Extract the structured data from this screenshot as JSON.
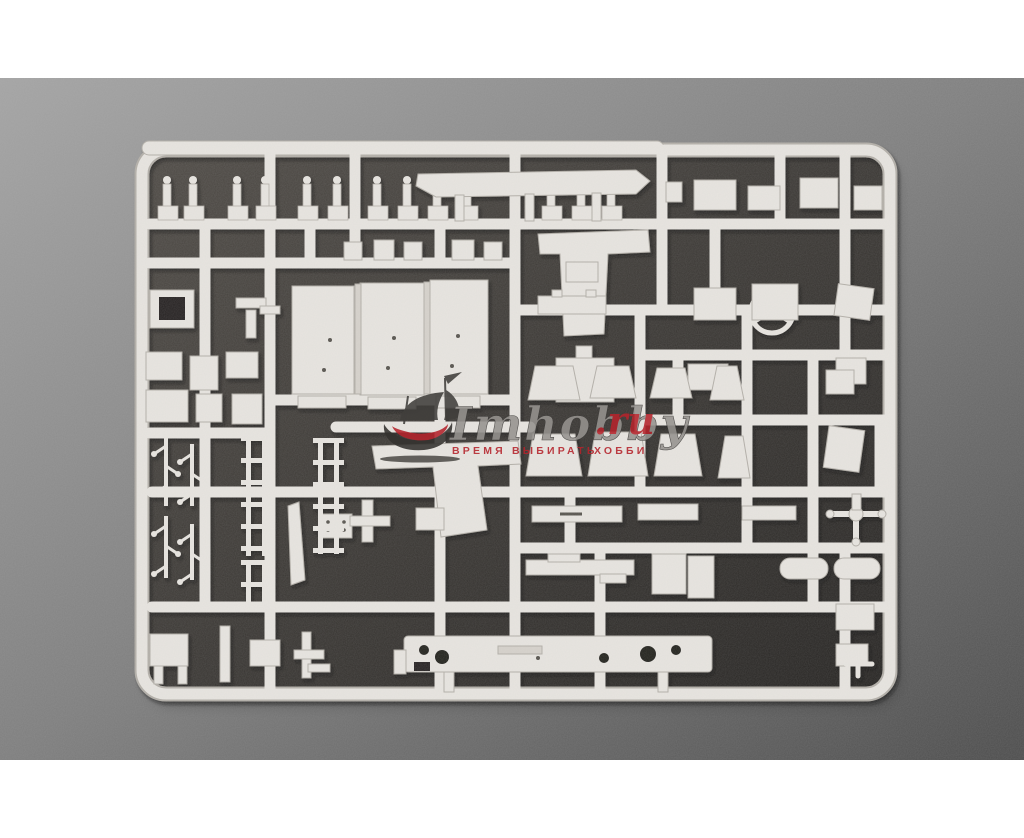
{
  "photo": {
    "palette": {
      "pageBg": "#ffffff",
      "bgTop": "#a4a4a4",
      "bgMid": "#7e7e7e",
      "bgBot": "#4c4c4c",
      "mat1": "#4e4a45",
      "mat2": "#262422",
      "plastic": "#e8e5e0",
      "edge": "#b3afa8",
      "dim": "#d6d2cb",
      "hole": "#23211f",
      "detail": "#57534d",
      "shadow": "#0a0a09"
    },
    "frame": {
      "x": 142,
      "y": 150,
      "w": 748,
      "h": 544,
      "rx": 24
    },
    "topbar": {
      "x": 142,
      "y": 141,
      "w": 522,
      "h": 14
    },
    "runners": [
      [
        150,
        224,
        884,
        224
      ],
      [
        150,
        263,
        513,
        263
      ],
      [
        515,
        310,
        884,
        310
      ],
      [
        640,
        355,
        884,
        355
      ],
      [
        272,
        400,
        513,
        400
      ],
      [
        640,
        420,
        884,
        420
      ],
      [
        150,
        433,
        268,
        433
      ],
      [
        152,
        492,
        884,
        492
      ],
      [
        515,
        548,
        884,
        548
      ],
      [
        152,
        607,
        884,
        607
      ],
      [
        336,
        427,
        530,
        427
      ],
      [
        205,
        224,
        205,
        607
      ],
      [
        270,
        150,
        270,
        688
      ],
      [
        310,
        224,
        310,
        263
      ],
      [
        355,
        150,
        355,
        263
      ],
      [
        440,
        224,
        440,
        263
      ],
      [
        440,
        400,
        440,
        688
      ],
      [
        515,
        150,
        515,
        688
      ],
      [
        570,
        492,
        570,
        548
      ],
      [
        600,
        548,
        600,
        688
      ],
      [
        640,
        310,
        640,
        492
      ],
      [
        662,
        150,
        662,
        310
      ],
      [
        678,
        355,
        678,
        420
      ],
      [
        715,
        224,
        715,
        310
      ],
      [
        747,
        310,
        747,
        548
      ],
      [
        780,
        150,
        780,
        224
      ],
      [
        813,
        355,
        813,
        607
      ],
      [
        845,
        150,
        845,
        355
      ],
      [
        845,
        548,
        845,
        688
      ],
      [
        880,
        420,
        880,
        492
      ]
    ],
    "parts": [
      {
        "t": "post",
        "x": 158
      },
      {
        "t": "post",
        "x": 184
      },
      {
        "t": "post",
        "x": 228
      },
      {
        "t": "post",
        "x": 256
      },
      {
        "t": "post",
        "x": 298
      },
      {
        "t": "post",
        "x": 328
      },
      {
        "t": "post",
        "x": 368
      },
      {
        "t": "post",
        "x": 398
      },
      {
        "t": "post",
        "x": 428
      },
      {
        "t": "post",
        "x": 458
      },
      {
        "t": "post",
        "x": 542
      },
      {
        "t": "post",
        "x": 572
      },
      {
        "t": "post",
        "x": 602
      },
      {
        "t": "poly",
        "pts": "418,174 636,170 650,181 636,194 436,197 416,186"
      },
      {
        "t": "rect",
        "x": 455,
        "y": 195,
        "w": 9,
        "h": 26
      },
      {
        "t": "rect",
        "x": 525,
        "y": 194,
        "w": 9,
        "h": 27
      },
      {
        "t": "rect",
        "x": 592,
        "y": 193,
        "w": 9,
        "h": 28
      },
      {
        "t": "rect",
        "x": 666,
        "y": 182,
        "w": 16,
        "h": 20
      },
      {
        "t": "rect",
        "x": 694,
        "y": 180,
        "w": 42,
        "h": 30
      },
      {
        "t": "rect",
        "x": 748,
        "y": 186,
        "w": 32,
        "h": 24
      },
      {
        "t": "rect",
        "x": 800,
        "y": 178,
        "w": 38,
        "h": 30
      },
      {
        "t": "rect",
        "x": 854,
        "y": 186,
        "w": 28,
        "h": 24
      },
      {
        "t": "rect",
        "x": 344,
        "y": 242,
        "w": 18,
        "h": 18
      },
      {
        "t": "rect",
        "x": 374,
        "y": 240,
        "w": 20,
        "h": 20
      },
      {
        "t": "rect",
        "x": 404,
        "y": 242,
        "w": 18,
        "h": 18
      },
      {
        "t": "rect",
        "x": 452,
        "y": 240,
        "w": 22,
        "h": 20
      },
      {
        "t": "rect",
        "x": 484,
        "y": 242,
        "w": 18,
        "h": 18
      },
      {
        "t": "rect",
        "x": 150,
        "y": 290,
        "w": 44,
        "h": 38
      },
      {
        "t": "rect",
        "x": 159,
        "y": 297,
        "w": 26,
        "h": 23,
        "f": "mat"
      },
      {
        "t": "rect",
        "x": 236,
        "y": 298,
        "w": 30,
        "h": 10
      },
      {
        "t": "rect",
        "x": 246,
        "y": 310,
        "w": 10,
        "h": 28
      },
      {
        "t": "rect",
        "x": 260,
        "y": 306,
        "w": 20,
        "h": 8
      },
      {
        "t": "rect",
        "x": 146,
        "y": 352,
        "w": 36,
        "h": 28
      },
      {
        "t": "rect",
        "x": 190,
        "y": 356,
        "w": 28,
        "h": 34
      },
      {
        "t": "rect",
        "x": 226,
        "y": 352,
        "w": 32,
        "h": 26
      },
      {
        "t": "rect",
        "x": 146,
        "y": 390,
        "w": 42,
        "h": 32
      },
      {
        "t": "rect",
        "x": 196,
        "y": 394,
        "w": 26,
        "h": 28
      },
      {
        "t": "rect",
        "x": 232,
        "y": 394,
        "w": 30,
        "h": 30
      },
      {
        "t": "rect",
        "x": 292,
        "y": 286,
        "w": 62,
        "h": 108
      },
      {
        "t": "rect",
        "x": 360,
        "y": 283,
        "w": 64,
        "h": 112
      },
      {
        "t": "rect",
        "x": 430,
        "y": 280,
        "w": 58,
        "h": 114
      },
      {
        "t": "rect",
        "x": 355,
        "y": 284,
        "w": 6,
        "h": 110,
        "f": "dim"
      },
      {
        "t": "rect",
        "x": 424,
        "y": 282,
        "w": 6,
        "h": 112,
        "f": "dim"
      },
      {
        "t": "rect",
        "x": 298,
        "y": 396,
        "w": 48,
        "h": 12
      },
      {
        "t": "rect",
        "x": 368,
        "y": 397,
        "w": 48,
        "h": 12
      },
      {
        "t": "rect",
        "x": 436,
        "y": 396,
        "w": 44,
        "h": 12
      },
      {
        "t": "dot",
        "cx": 324,
        "cy": 370,
        "r": 2
      },
      {
        "t": "dot",
        "cx": 330,
        "cy": 340,
        "r": 2
      },
      {
        "t": "dot",
        "cx": 388,
        "cy": 368,
        "r": 2
      },
      {
        "t": "dot",
        "cx": 394,
        "cy": 338,
        "r": 2
      },
      {
        "t": "dot",
        "cx": 452,
        "cy": 366,
        "r": 2
      },
      {
        "t": "dot",
        "cx": 458,
        "cy": 336,
        "r": 2
      },
      {
        "t": "poly",
        "pts": "538,234 648,230 650,252 608,254 604,334 564,336 560,254 540,254"
      },
      {
        "t": "rect",
        "x": 566,
        "y": 262,
        "w": 32,
        "h": 20
      },
      {
        "t": "ring",
        "cx": 772,
        "cy": 312,
        "r": 21,
        "w": 5
      },
      {
        "t": "line",
        "x1": 772,
        "y1": 312,
        "x2": 772,
        "y2": 293,
        "w": 3
      },
      {
        "t": "line",
        "x1": 772,
        "y1": 312,
        "x2": 755,
        "y2": 322,
        "w": 3
      },
      {
        "t": "line",
        "x1": 772,
        "y1": 312,
        "x2": 789,
        "y2": 322,
        "w": 3
      },
      {
        "t": "circle",
        "cx": 772,
        "cy": 312,
        "r": 4.5
      },
      {
        "t": "rect",
        "x": 694,
        "y": 288,
        "w": 42,
        "h": 32
      },
      {
        "t": "rect",
        "x": 752,
        "y": 284,
        "w": 46,
        "h": 36
      },
      {
        "t": "rect",
        "x": 836,
        "y": 286,
        "w": 36,
        "h": 32,
        "rot": 8
      },
      {
        "t": "rect",
        "x": 688,
        "y": 364,
        "w": 40,
        "h": 26
      },
      {
        "t": "rect",
        "x": 836,
        "y": 358,
        "w": 30,
        "h": 26
      },
      {
        "t": "rect",
        "x": 538,
        "y": 296,
        "w": 68,
        "h": 18
      },
      {
        "t": "rect",
        "x": 552,
        "y": 290,
        "w": 10,
        "h": 7
      },
      {
        "t": "rect",
        "x": 586,
        "y": 290,
        "w": 10,
        "h": 7
      },
      {
        "t": "rect",
        "x": 556,
        "y": 358,
        "w": 58,
        "h": 44
      },
      {
        "t": "rect",
        "x": 576,
        "y": 346,
        "w": 16,
        "h": 12
      },
      {
        "t": "trap",
        "x": 528,
        "y": 366,
        "w": 52,
        "h": 34
      },
      {
        "t": "trap",
        "x": 590,
        "y": 366,
        "w": 46,
        "h": 32
      },
      {
        "t": "trap",
        "x": 650,
        "y": 368,
        "w": 42,
        "h": 30
      },
      {
        "t": "trap",
        "x": 710,
        "y": 366,
        "w": 34,
        "h": 34
      },
      {
        "t": "trap",
        "x": 526,
        "y": 434,
        "w": 56,
        "h": 42
      },
      {
        "t": "trap",
        "x": 588,
        "y": 432,
        "w": 60,
        "h": 44
      },
      {
        "t": "trap",
        "x": 654,
        "y": 434,
        "w": 48,
        "h": 42
      },
      {
        "t": "trap",
        "x": 718,
        "y": 436,
        "w": 32,
        "h": 42
      },
      {
        "t": "rect",
        "x": 826,
        "y": 428,
        "w": 36,
        "h": 42,
        "rot": 8
      },
      {
        "t": "rect",
        "x": 826,
        "y": 370,
        "w": 28,
        "h": 24
      },
      {
        "t": "poly",
        "pts": "372,446 518,441 521,464 478,466 487,530 441,537 433,467 376,469"
      },
      {
        "t": "poly",
        "pts": "288,506 299,502 305,580 291,585"
      },
      {
        "t": "rect",
        "x": 320,
        "y": 514,
        "w": 32,
        "h": 24
      },
      {
        "t": "dot",
        "cx": 328,
        "cy": 522,
        "r": 1.8
      },
      {
        "t": "dot",
        "cx": 336,
        "cy": 522,
        "r": 1.8
      },
      {
        "t": "dot",
        "cx": 344,
        "cy": 522,
        "r": 1.8
      },
      {
        "t": "dot",
        "cx": 328,
        "cy": 530,
        "r": 1.8
      },
      {
        "t": "dot",
        "cx": 336,
        "cy": 530,
        "r": 1.8
      },
      {
        "t": "dot",
        "cx": 344,
        "cy": 530,
        "r": 1.8
      },
      {
        "t": "rect",
        "x": 362,
        "y": 500,
        "w": 11,
        "h": 42
      },
      {
        "t": "rect",
        "x": 350,
        "y": 516,
        "w": 40,
        "h": 10
      },
      {
        "t": "rect",
        "x": 416,
        "y": 508,
        "w": 28,
        "h": 22
      },
      {
        "t": "rect",
        "x": 532,
        "y": 506,
        "w": 90,
        "h": 16
      },
      {
        "t": "dline",
        "x1": 560,
        "y1": 514,
        "x2": 582,
        "y2": 514,
        "w": 3
      },
      {
        "t": "rect",
        "x": 638,
        "y": 504,
        "w": 60,
        "h": 16
      },
      {
        "t": "rect",
        "x": 742,
        "y": 506,
        "w": 54,
        "h": 14
      },
      {
        "t": "rect",
        "x": 526,
        "y": 560,
        "w": 108,
        "h": 15
      },
      {
        "t": "rect",
        "x": 548,
        "y": 554,
        "w": 32,
        "h": 8
      },
      {
        "t": "rect",
        "x": 600,
        "y": 574,
        "w": 26,
        "h": 9
      },
      {
        "t": "rect",
        "x": 652,
        "y": 554,
        "w": 34,
        "h": 40
      },
      {
        "t": "rect",
        "x": 688,
        "y": 556,
        "w": 26,
        "h": 42
      },
      {
        "t": "rrect",
        "x": 780,
        "y": 558,
        "w": 48,
        "h": 21,
        "r": 10
      },
      {
        "t": "rrect",
        "x": 834,
        "y": 558,
        "w": 46,
        "h": 21,
        "r": 10
      },
      {
        "t": "line",
        "x1": 830,
        "y1": 514,
        "x2": 882,
        "y2": 514,
        "w": 6
      },
      {
        "t": "line",
        "x1": 856,
        "y1": 514,
        "x2": 856,
        "y2": 542,
        "w": 6
      },
      {
        "t": "circle",
        "cx": 856,
        "cy": 514,
        "r": 7
      },
      {
        "t": "circle",
        "cx": 830,
        "cy": 514,
        "r": 4
      },
      {
        "t": "circle",
        "cx": 882,
        "cy": 514,
        "r": 4
      },
      {
        "t": "circle",
        "cx": 856,
        "cy": 542,
        "r": 4
      },
      {
        "t": "rect",
        "x": 852,
        "y": 494,
        "w": 9,
        "h": 16
      },
      {
        "t": "rect",
        "x": 836,
        "y": 604,
        "w": 38,
        "h": 26
      },
      {
        "t": "rect",
        "x": 836,
        "y": 644,
        "w": 32,
        "h": 22
      },
      {
        "t": "line",
        "x1": 846,
        "y1": 664,
        "x2": 872,
        "y2": 664,
        "w": 5
      },
      {
        "t": "line",
        "x1": 858,
        "y1": 652,
        "x2": 858,
        "y2": 676,
        "w": 5
      },
      {
        "t": "rrect",
        "x": 404,
        "y": 636,
        "w": 308,
        "h": 36,
        "r": 4
      },
      {
        "t": "hole",
        "cx": 424,
        "cy": 650,
        "r": 5
      },
      {
        "t": "hole",
        "cx": 442,
        "cy": 657,
        "r": 7
      },
      {
        "t": "hole",
        "cx": 604,
        "cy": 658,
        "r": 5
      },
      {
        "t": "hole",
        "cx": 648,
        "cy": 654,
        "r": 8
      },
      {
        "t": "hole",
        "cx": 676,
        "cy": 650,
        "r": 5
      },
      {
        "t": "rect",
        "x": 414,
        "y": 662,
        "w": 16,
        "h": 9,
        "f": "mat"
      },
      {
        "t": "rect",
        "x": 498,
        "y": 646,
        "w": 44,
        "h": 8,
        "f": "dim"
      },
      {
        "t": "dot",
        "cx": 538,
        "cy": 658,
        "r": 2
      },
      {
        "t": "rect",
        "x": 444,
        "y": 672,
        "w": 10,
        "h": 20
      },
      {
        "t": "rect",
        "x": 658,
        "y": 672,
        "w": 10,
        "h": 20
      },
      {
        "t": "rect",
        "x": 394,
        "y": 650,
        "w": 12,
        "h": 24
      },
      {
        "t": "rect",
        "x": 150,
        "y": 634,
        "w": 38,
        "h": 32
      },
      {
        "t": "rect",
        "x": 154,
        "y": 666,
        "w": 9,
        "h": 18
      },
      {
        "t": "rect",
        "x": 178,
        "y": 666,
        "w": 9,
        "h": 18
      },
      {
        "t": "rect",
        "x": 220,
        "y": 626,
        "w": 10,
        "h": 56
      },
      {
        "t": "rect",
        "x": 250,
        "y": 640,
        "w": 30,
        "h": 26
      },
      {
        "t": "rect",
        "x": 302,
        "y": 632,
        "w": 9,
        "h": 46
      },
      {
        "t": "rect",
        "x": 294,
        "y": 650,
        "w": 30,
        "h": 9
      },
      {
        "t": "rect",
        "x": 308,
        "y": 664,
        "w": 22,
        "h": 8
      },
      {
        "t": "ladder",
        "x": 246,
        "y": 436,
        "h": 120
      },
      {
        "t": "ladder",
        "x": 318,
        "y": 438,
        "h": 116
      },
      {
        "t": "ladder",
        "x": 246,
        "y": 560,
        "h": 44
      },
      {
        "t": "branch",
        "x": 166,
        "y": 436,
        "h": 70
      },
      {
        "t": "branch",
        "x": 192,
        "y": 444,
        "h": 62
      },
      {
        "t": "branch",
        "x": 166,
        "y": 516,
        "h": 62
      },
      {
        "t": "branch",
        "x": 192,
        "y": 524,
        "h": 56
      }
    ]
  },
  "watermark": {
    "brand_script": "Imhobby",
    "brand_tld": ".ru",
    "slogan_left": "ВРЕМЯ ВЫБИРАТЬ",
    "slogan_right": "ХОББИ",
    "gray": "#96938f",
    "red": "#b5242c",
    "ink": "#413f3c"
  }
}
